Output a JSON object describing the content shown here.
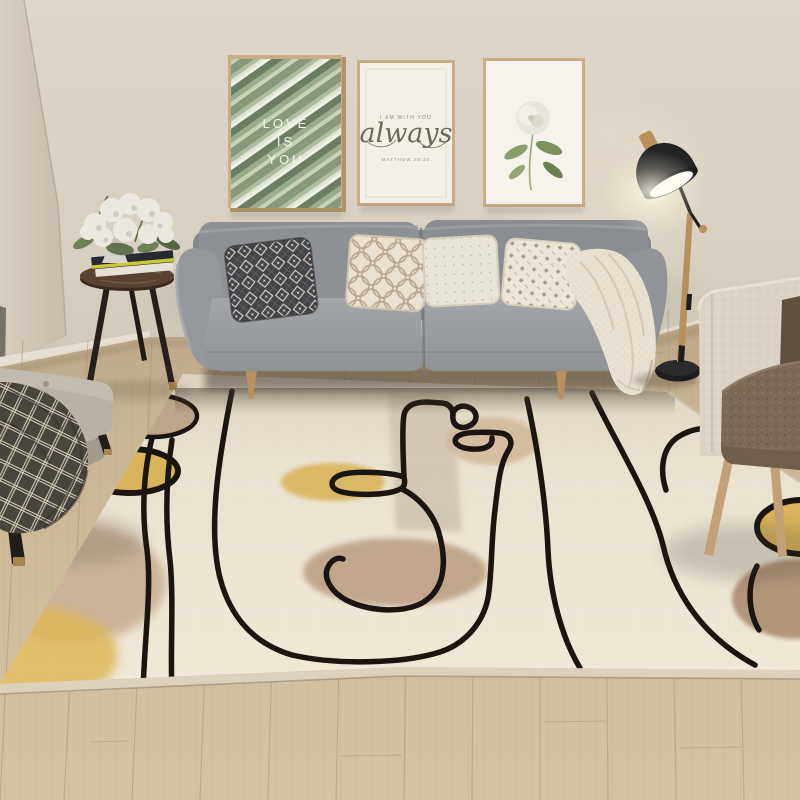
{
  "meta": {
    "title": "Scandinavian living room photo with abstract one-line-art area rug",
    "kind": "photograph"
  },
  "palette": {
    "wall": "#d9d2c3",
    "wall_left": "#cec6b6",
    "floor": "#cbb795",
    "rug_field": "#eae2d1",
    "rug_line": "#1a1510",
    "accent_yellow": "#d9b45a",
    "accent_tan": "#bfa78c",
    "sofa_gray": "#8f9295",
    "lamp_black": "#232325",
    "wood": "#b98f5a"
  },
  "wall_art": {
    "frame1": {
      "line1": "LOVE",
      "line2": "IS",
      "line3": "YOU",
      "subject": "green palm leaf print"
    },
    "frame2": {
      "eyebrow": "I AM WITH YOU",
      "script": "always",
      "caption": "MATTHEW 28:20"
    },
    "frame3": {
      "subject": "white rose print"
    }
  },
  "objects": {
    "sofa": "gray three-seat sofa with four patterned pillows and cream throw",
    "rug": "cream rug with black abstract line drawing, yellow and tan ovals",
    "side_table": "round dark wood tripod table with white flowers and books",
    "ottoman": "gray tufted bench with dark plaid blanket",
    "floor_lamp": "black and wood arc floor lamp, lit",
    "armchair": "cream boucle armchair with brown cushion"
  }
}
